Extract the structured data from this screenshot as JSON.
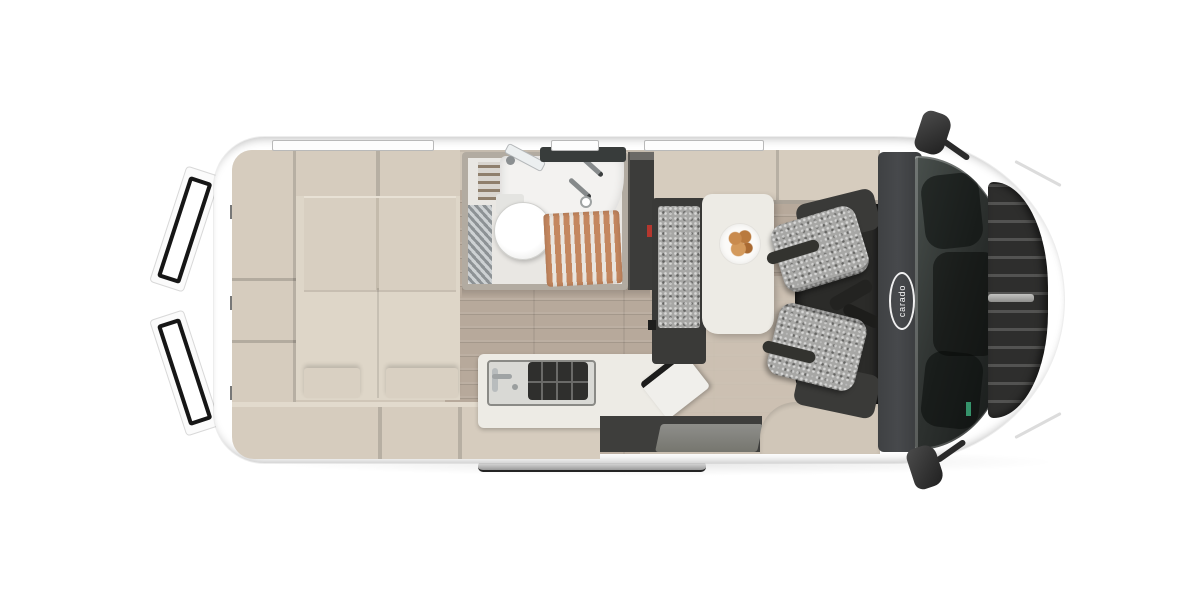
{
  "scene": {
    "type": "campervan-floorplan-top-view",
    "brand_logo": "carado"
  },
  "colors": {
    "background": "#ffffff",
    "body_white": "#ffffff",
    "interior_wall": "#d0c6b8",
    "cabinet": "#d6ccbe",
    "bed_platform": "#ded6c8",
    "headboard": "#d8cfc1",
    "floor_wood": "#b7a99b",
    "floor_light": "#cdc2b4",
    "bathroom_wall": "#b2aba1",
    "bathroom_floor": "#e9e7e3",
    "shower_slats": "#c4875f",
    "fixture_white": "#f3f2f0",
    "wardrobe_dark": "#3c3c3a",
    "seat_fabric": "#a7a7a5",
    "seat_frame": "#3a3a38",
    "table_white": "#edebe5",
    "glass_dark": "#2d312f",
    "cab_band": "#47494c",
    "grille_dark": "#2e2e2d",
    "accent_red": "#b5372e",
    "croissant": "#c98b4e",
    "step_gray": "#8e8e8a",
    "mirror_dark": "#1f1f1f",
    "door_seal": "#161616",
    "window_trim": "#b9b9b9",
    "sticker_green": "#35936b"
  }
}
